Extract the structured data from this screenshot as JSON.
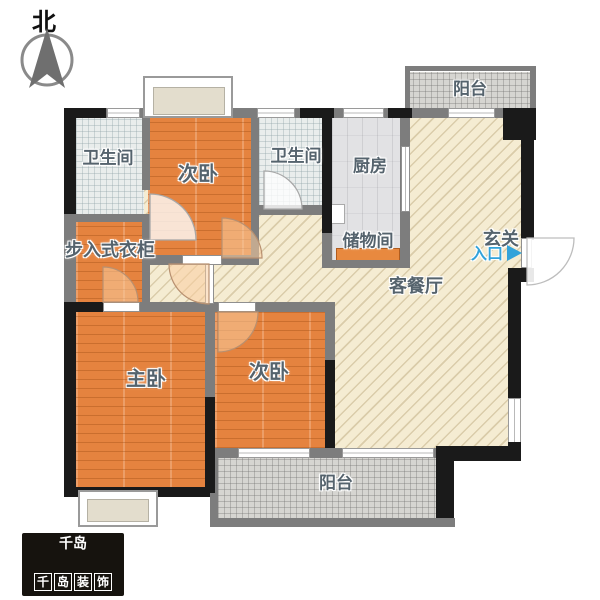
{
  "compass": {
    "label": "北"
  },
  "rooms": {
    "bath1": {
      "label": "卫生间"
    },
    "bedroom1": {
      "label": "次卧"
    },
    "bath2": {
      "label": "卫生间"
    },
    "kitchen": {
      "label": "厨房"
    },
    "balcony_top": {
      "label": "阳台"
    },
    "storage": {
      "label": "储物间"
    },
    "foyer": {
      "label": "玄关"
    },
    "living": {
      "label": "客餐厅"
    },
    "closet": {
      "label": "步入式衣柜"
    },
    "master": {
      "label": "主卧"
    },
    "bedroom2": {
      "label": "次卧"
    },
    "balcony_bottom": {
      "label": "阳台"
    }
  },
  "entry": {
    "label": "入口"
  },
  "logo": {
    "mark": "千岛",
    "chars": [
      "千",
      "岛",
      "装",
      "饰"
    ]
  },
  "colors": {
    "wood_floor": "#e5833f",
    "living_floor": "#f5ecd2",
    "tile_floor": "#e9edec",
    "kitchen_floor": "#e2e2e4",
    "balcony_floor": "#d6d5d1",
    "wall_gray": "#7d7d7d",
    "wall_black": "#1a1a1a",
    "label_text": "#55636d",
    "entry_blue": "#33a3da",
    "logo_bg": "#16130e"
  }
}
